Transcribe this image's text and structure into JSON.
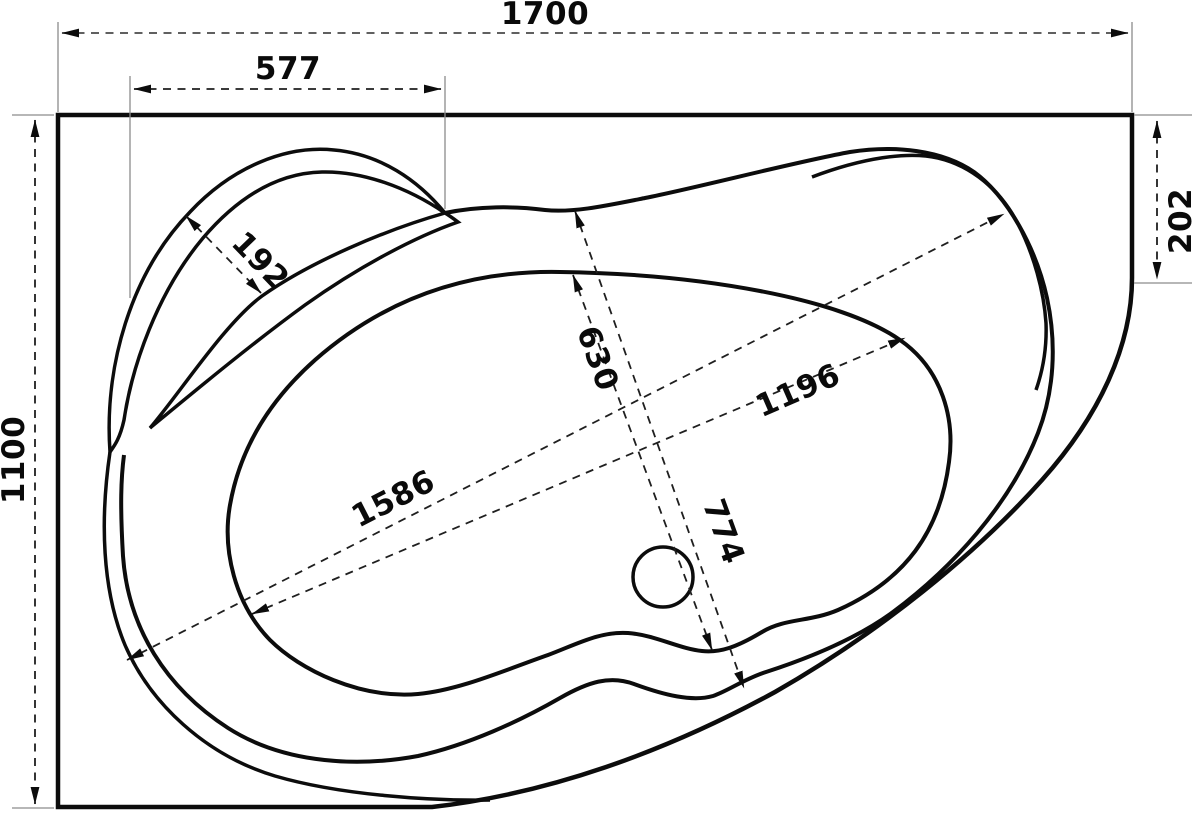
{
  "drawing": {
    "subject": "corner-bathtub-top-view-dimension-drawing",
    "background": "#ffffff",
    "line_color": "#0c0c0c",
    "dimension_line_color": "#1f1f1f",
    "extension_line_color": "#8c8c8c",
    "dims": {
      "overall_width": "1700",
      "headrest_edge_width": "577",
      "overall_depth": "1100",
      "right_edge_depth": "202",
      "headrest_rim_width": "192",
      "basin_inner_width": "630",
      "rim_width": "774",
      "basin_inner_length": "1196",
      "rim_length": "1586"
    }
  }
}
